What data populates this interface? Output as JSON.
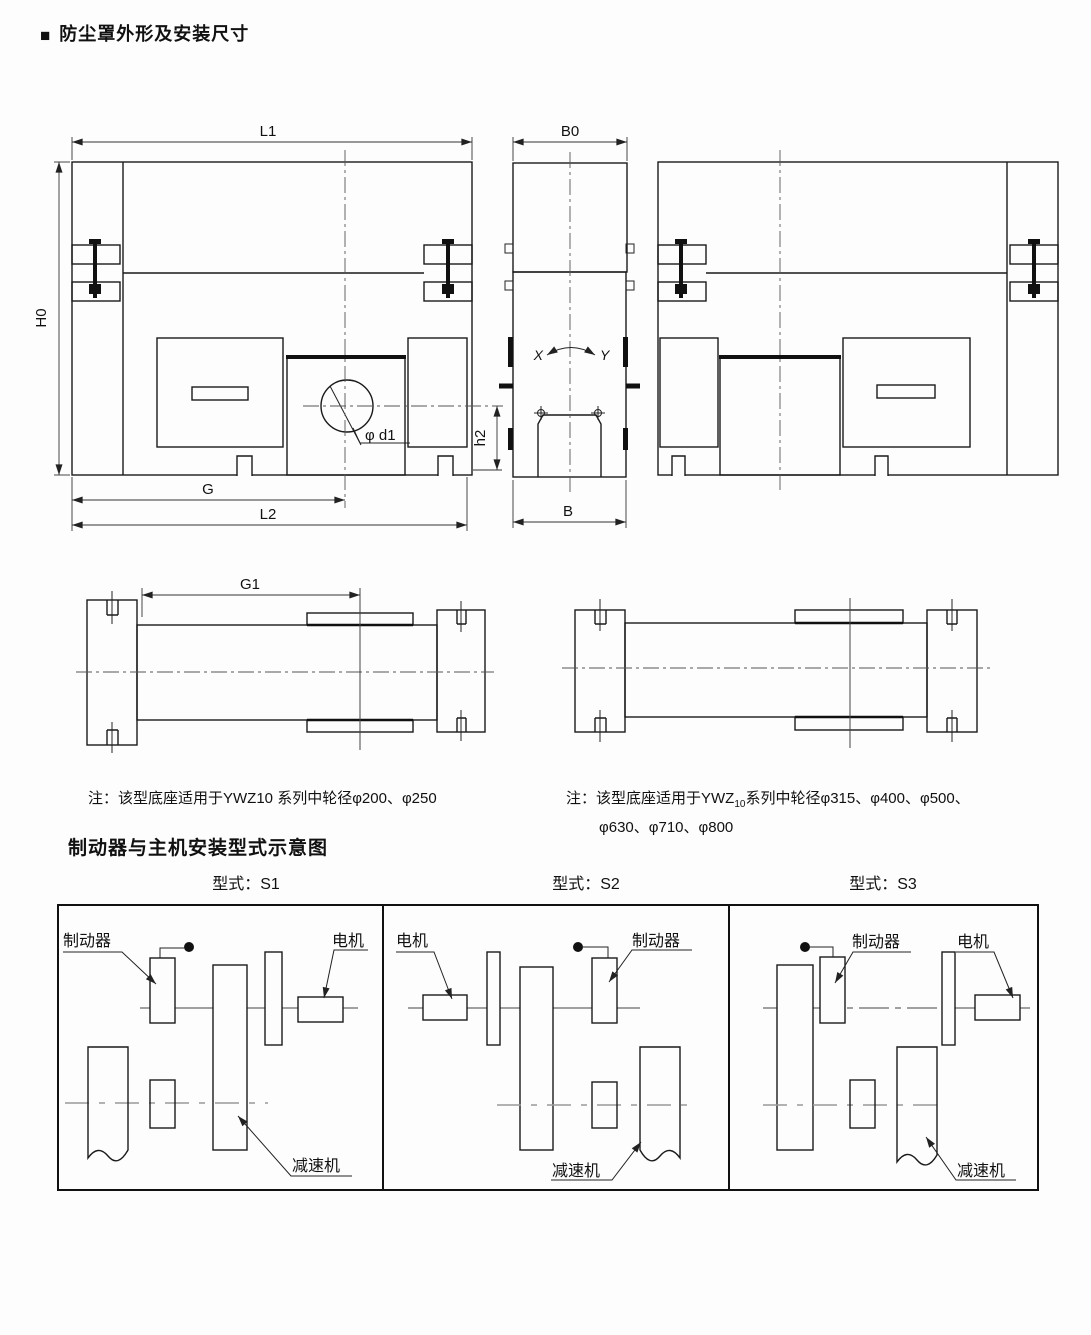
{
  "header": {
    "bullet": "■",
    "title": "防尘罩外形及安装尺寸"
  },
  "dims": {
    "L1": "L1",
    "H0": "H0",
    "B0": "B0",
    "B": "B",
    "G": "G",
    "L2": "L2",
    "G1": "G1",
    "h2": "h2",
    "phi_d1": "φ d1",
    "X": "X",
    "Y": "Y"
  },
  "notes": {
    "left": {
      "prefix": "注：",
      "before_sub": "该型底座适用于YWZ",
      "sub": "10",
      "after_sub": " 系列中轮径φ200、φ250"
    },
    "right": {
      "prefix": "注：",
      "before_sub": "该型底座适用于YWZ",
      "sub": "10",
      "line1": "系列中轮径φ315、φ400、φ500、",
      "line2": "φ630、φ710、φ800"
    }
  },
  "section_heading": "制动器与主机安装型式示意图",
  "panels": [
    {
      "title": "型式：S1",
      "brake": "制动器",
      "motor": "电机",
      "reducer": "减速机"
    },
    {
      "title": "型式：S2",
      "brake": "制动器",
      "motor": "电机",
      "reducer": "减速机"
    },
    {
      "title": "型式：S3",
      "brake": "制动器",
      "motor": "电机",
      "reducer": "减速机"
    }
  ],
  "colors": {
    "line": "#1a1a1a",
    "dimension": "#333333",
    "centerline": "#555555",
    "panel_centerline": "#9a9a9a",
    "background": "#fdfdfd"
  }
}
